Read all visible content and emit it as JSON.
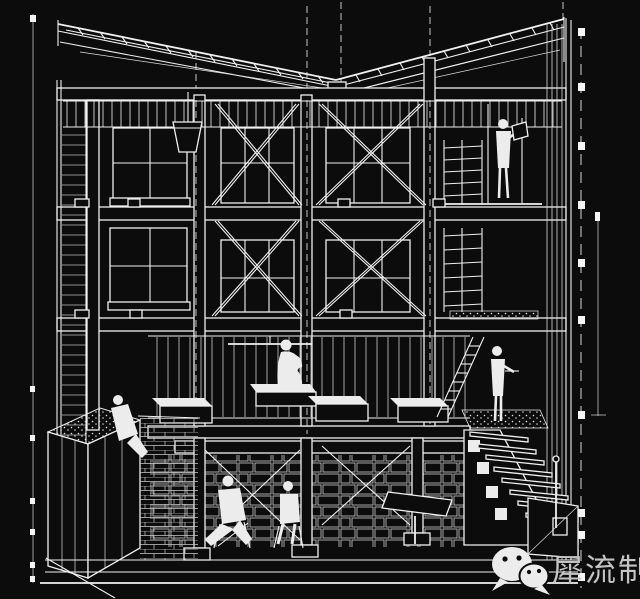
{
  "canvas": {
    "background": "#0c0c0c",
    "line_color": "#f0f0f0"
  },
  "watermark": {
    "text": "犀流制报",
    "color": "#c4c4c4",
    "logo_icon": "wechat-logo"
  }
}
